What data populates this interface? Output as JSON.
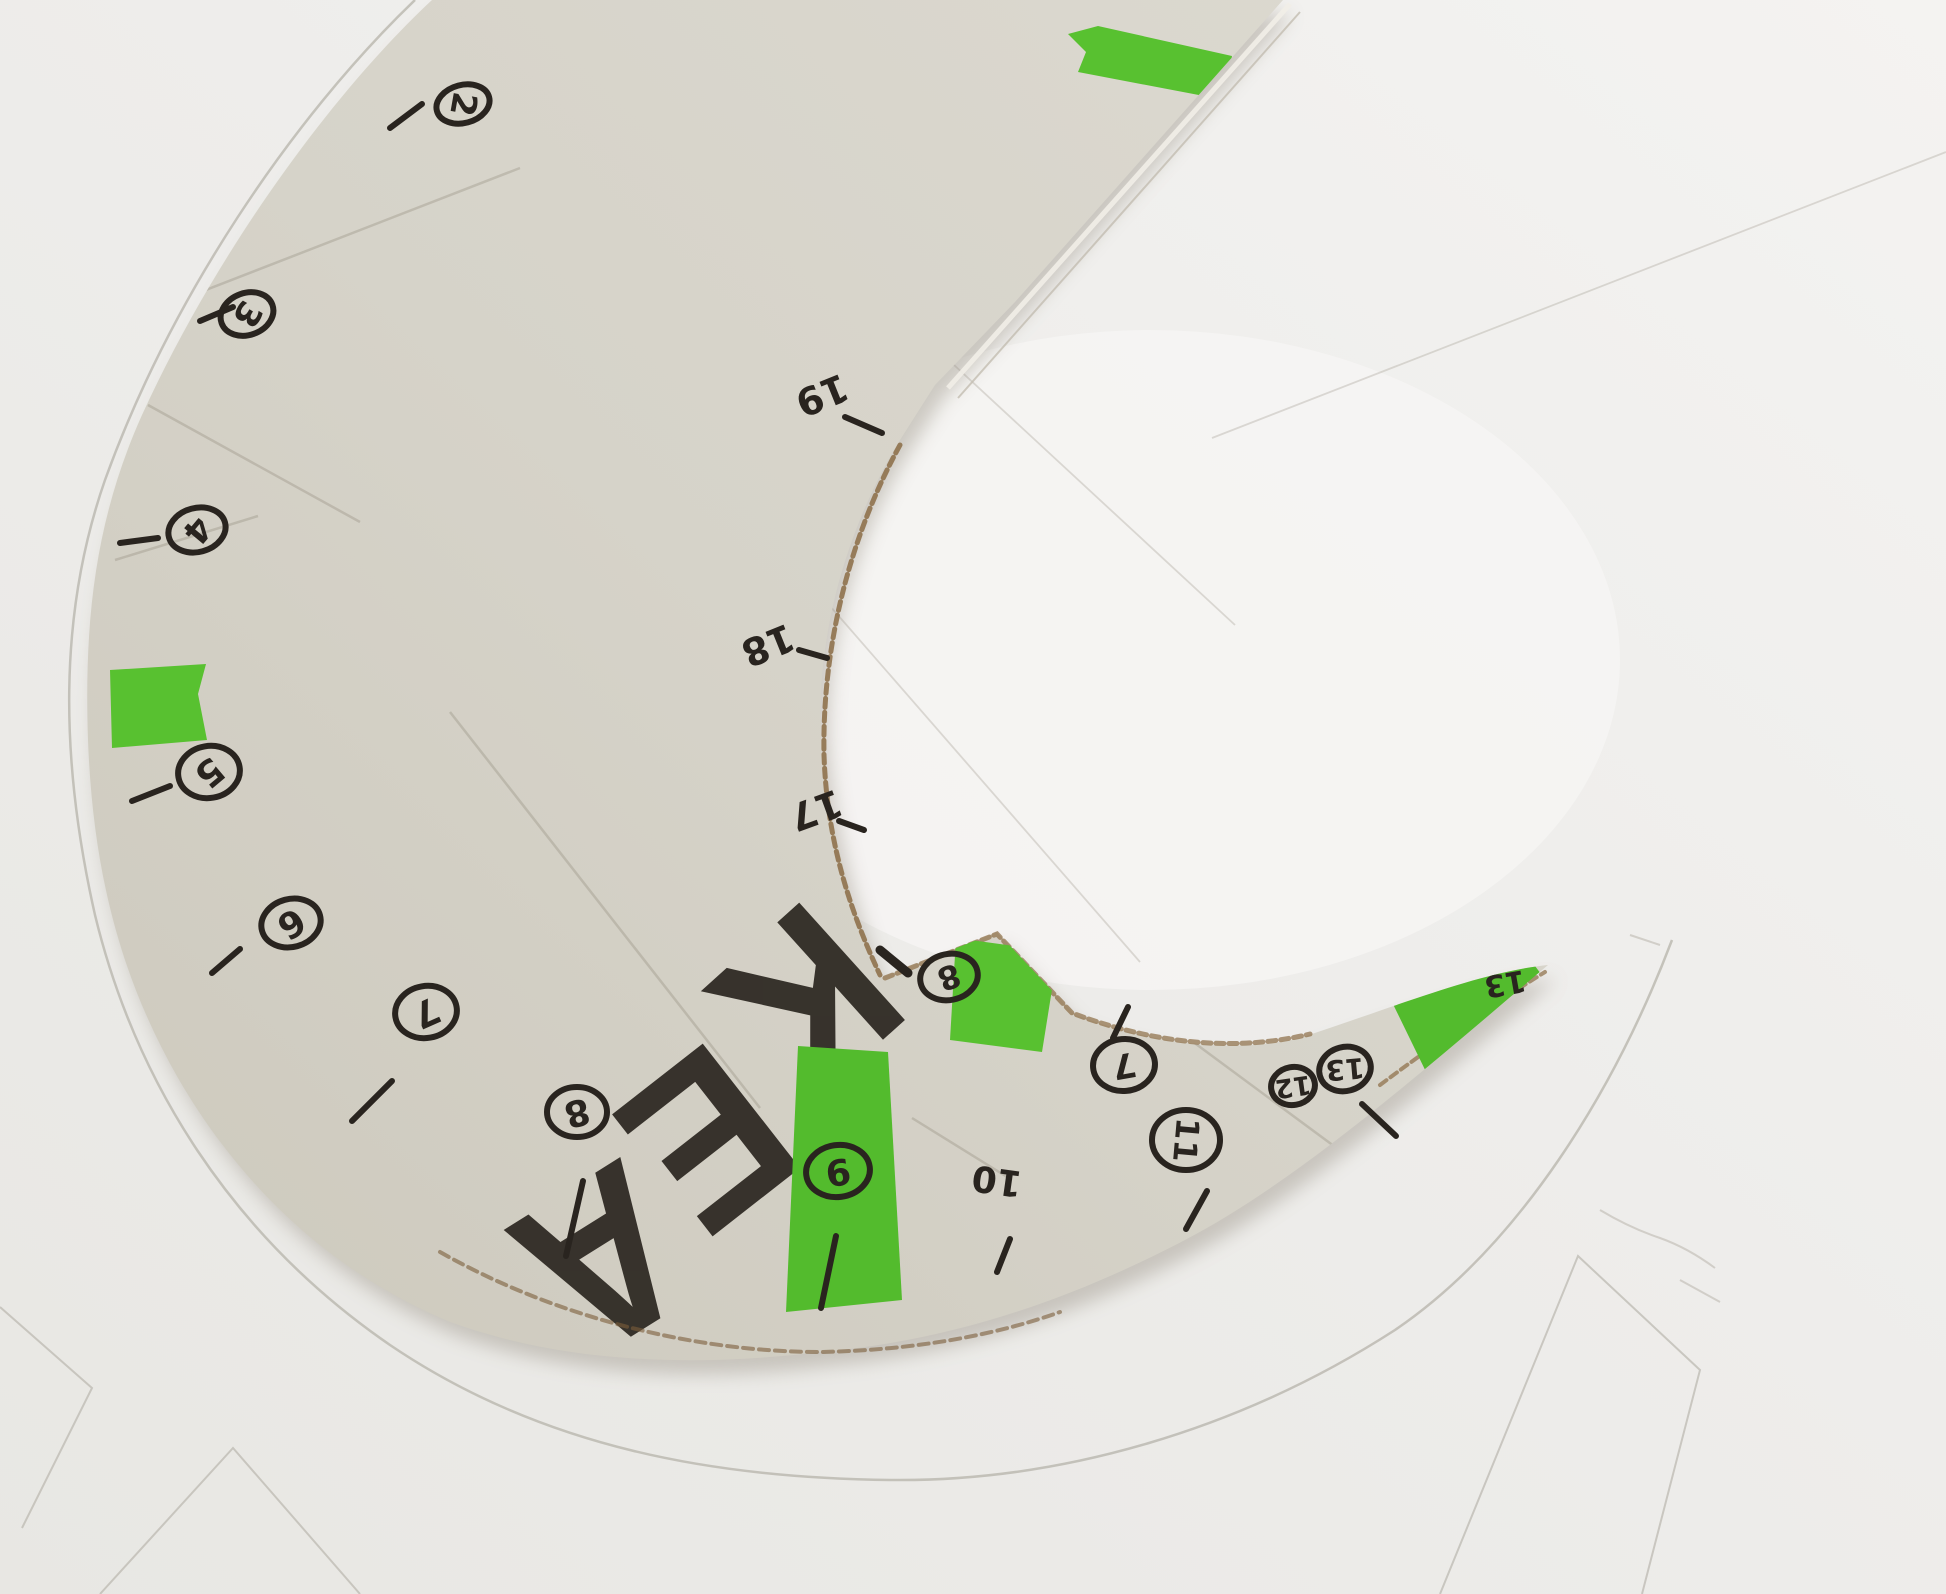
{
  "colors": {
    "paper_dark": "#e8e7e3",
    "paper_light": "#f4f3f1",
    "paper_hole_bright": "#f6f5f3",
    "cardboard_dark": "#cdc9bd",
    "cardboard_light": "#dcd9d0",
    "ink": "#29241f",
    "letter_ink": "#2c2721",
    "tape_green": "#58c130",
    "tape_green_alt": "#53bb2d",
    "torn_brown": "#8b6c45",
    "torn_brown_dark": "#7c5e3b",
    "print_line": "#b9b6ae",
    "pencil_line": "#c9c6bf",
    "shadow": "#9b9488",
    "cut_highlight": "#f2efe8",
    "cut_shadow_line": "#c4beb2",
    "crease_card": "rgba(120,110,95,0.25)",
    "crease_paper": "rgba(160,152,140,0.32)"
  },
  "cardboard": {
    "outline_path": "M 432,0 C 330,95 215,255 142,415 C 95,520 84,620 88,740 C 93,875 122,980 178,1078 C 240,1185 330,1272 450,1322 C 560,1362 690,1368 820,1352 C 960,1340 1080,1295 1185,1240 C 1300,1180 1430,1065 1548,965 C 1480,972 1400,1005 1300,1038 C 1240,1052 1165,1048 1075,1015 L 997,932 L 880,978 C 855,915 833,845 822,750 C 813,645 845,530 900,440 L 935,385 L 1015,302 L 1283,0 Z",
    "creases": [
      "M 180,300 L 520,168",
      "M 148,405 L 360,522",
      "M 115,560 L 258,516",
      "M 450,712 L 760,1108",
      "M 1058,942 L 1342,1152",
      "M 912,1118 L 1012,1180"
    ],
    "torn_edges": [
      {
        "d": "M 900,445 C 848,540 822,650 824,755 C 827,845 852,915 880,975",
        "color": "#8b6c45",
        "w": 5,
        "dash": "9 5",
        "o": 0.85
      },
      {
        "d": "M 885,978 L 997,934 L 1072,1013 C 1160,1046 1240,1051 1310,1034",
        "color": "#8b6c45",
        "w": 5,
        "dash": "8 5",
        "o": 0.7
      },
      {
        "d": "M 440,1252 C 560,1320 700,1352 820,1352 C 930,1350 1010,1330 1060,1312",
        "color": "#7c5e3b",
        "w": 4,
        "dash": "10 6",
        "o": 0.6
      },
      {
        "d": "M 1380,1085 C 1440,1040 1500,1000 1545,972",
        "color": "#8b6c45",
        "w": 4,
        "dash": "8 5",
        "o": 0.7
      }
    ],
    "cut_edge_highlight": {
      "x1": 1290,
      "y1": 4,
      "x2": 948,
      "y2": 388
    },
    "cut_edge_shadow": {
      "x1": 1300,
      "y1": 12,
      "x2": 958,
      "y2": 398
    }
  },
  "brand_text": {
    "word": "IKEA",
    "letters": [
      {
        "ch": "I",
        "x": 905,
        "y": 795,
        "rot": 142,
        "size": 205
      },
      {
        "ch": "K",
        "x": 795,
        "y": 988,
        "rot": 138,
        "size": 205
      },
      {
        "ch": "E",
        "x": 697,
        "y": 1125,
        "rot": 142,
        "size": 205
      },
      {
        "ch": "A",
        "x": 594,
        "y": 1245,
        "rot": 148,
        "size": 205
      }
    ]
  },
  "tape_pieces": [
    {
      "name": "tape-top",
      "points": "1068,34 1098,26 1232,56 1225,100 1078,72 1086,52",
      "color": "#58c130"
    },
    {
      "name": "tape-left",
      "points": "110,670 206,664 198,694 207,740 112,748",
      "color": "#58c130"
    },
    {
      "name": "tape-bottom-strip",
      "points": "798,1046 888,1052 902,1300 786,1312",
      "color": "#53bb2d"
    },
    {
      "name": "tape-inner-edge",
      "points": "956,938 1058,952 1042,1052 950,1040",
      "color": "#58c130"
    },
    {
      "name": "tape-right-tip",
      "points": "1392,1002 1520,946 1550,986 1430,1080",
      "color": "#53bb2d"
    }
  ],
  "edge_markers": [
    {
      "label": "2",
      "circled": true,
      "x": 463,
      "y": 104,
      "rx": 27,
      "ry": 19,
      "erot": -15,
      "drot": 100,
      "fs": 34,
      "tick": [
        390,
        128,
        422,
        104
      ]
    },
    {
      "label": "3",
      "circled": true,
      "x": 247,
      "y": 314,
      "rx": 27,
      "ry": 21,
      "erot": -20,
      "drot": 120,
      "fs": 34,
      "tick": [
        200,
        321,
        233,
        307
      ]
    },
    {
      "label": "4",
      "circled": true,
      "x": 197,
      "y": 530,
      "rx": 29,
      "ry": 22,
      "erot": -15,
      "drot": 130,
      "fs": 34,
      "tick": [
        120,
        543,
        158,
        538
      ]
    },
    {
      "label": "5",
      "circled": true,
      "x": 209,
      "y": 772,
      "rx": 31,
      "ry": 26,
      "erot": -10,
      "drot": 140,
      "fs": 36,
      "tick": [
        132,
        801,
        170,
        786
      ]
    },
    {
      "label": "6",
      "circled": true,
      "x": 291,
      "y": 923,
      "rx": 30,
      "ry": 24,
      "erot": -15,
      "drot": 148,
      "fs": 36,
      "tick": [
        212,
        973,
        240,
        949
      ]
    },
    {
      "label": "7",
      "circled": true,
      "x": 426,
      "y": 1012,
      "rx": 31,
      "ry": 26,
      "erot": -10,
      "drot": 156,
      "fs": 36,
      "tick": [
        352,
        1121,
        392,
        1081
      ]
    },
    {
      "label": "8",
      "circled": true,
      "x": 577,
      "y": 1112,
      "rx": 30,
      "ry": 25,
      "erot": 0,
      "drot": 165,
      "fs": 36,
      "tick": [
        583,
        1181,
        566,
        1256
      ]
    },
    {
      "label": "9",
      "circled": true,
      "x": 838,
      "y": 1171,
      "rx": 32,
      "ry": 26,
      "erot": -8,
      "drot": 172,
      "fs": 36,
      "tick": [
        836,
        1236,
        821,
        1308
      ]
    },
    {
      "label": "10",
      "circled": false,
      "x": 997,
      "y": 1180,
      "rx": 0,
      "ry": 0,
      "erot": 0,
      "drot": 188,
      "fs": 36,
      "tick": [
        1010,
        1239,
        997,
        1272
      ]
    },
    {
      "label": "11",
      "circled": true,
      "x": 1186,
      "y": 1140,
      "rx": 34,
      "ry": 30,
      "erot": 0,
      "drot": 95,
      "fs": 32,
      "tick": [
        1207,
        1191,
        1186,
        1229
      ]
    },
    {
      "label": "8",
      "circled": true,
      "x": 949,
      "y": 977,
      "rx": 29,
      "ry": 23,
      "erot": -12,
      "drot": 160,
      "fs": 32,
      "tick": null
    },
    {
      "label": "7",
      "circled": true,
      "x": 1124,
      "y": 1065,
      "rx": 31,
      "ry": 26,
      "erot": -5,
      "drot": 170,
      "fs": 34,
      "tick": [
        1113,
        1038,
        1128,
        1007
      ]
    },
    {
      "label": "12",
      "circled": true,
      "x": 1293,
      "y": 1086,
      "rx": 22,
      "ry": 19,
      "erot": -10,
      "drot": 172,
      "fs": 26,
      "tick": null
    },
    {
      "label": "13",
      "circled": true,
      "x": 1345,
      "y": 1069,
      "rx": 26,
      "ry": 22,
      "erot": -15,
      "drot": 175,
      "fs": 28,
      "tick": null
    },
    {
      "label": "13",
      "circled": false,
      "x": 1505,
      "y": 983,
      "rx": 0,
      "ry": 0,
      "erot": 0,
      "drot": 170,
      "fs": 30,
      "tick": null
    },
    {
      "label": "19",
      "circled": false,
      "x": 822,
      "y": 395,
      "rx": 0,
      "ry": 0,
      "erot": 0,
      "drot": 158,
      "fs": 38,
      "tick": [
        845,
        417,
        882,
        433
      ]
    },
    {
      "label": "18",
      "circled": false,
      "x": 768,
      "y": 645,
      "rx": 0,
      "ry": 0,
      "erot": 0,
      "drot": 158,
      "fs": 38,
      "tick": [
        799,
        650,
        827,
        658
      ]
    },
    {
      "label": "17",
      "circled": false,
      "x": 816,
      "y": 810,
      "rx": 0,
      "ry": 0,
      "erot": 0,
      "drot": 160,
      "fs": 38,
      "tick": [
        839,
        821,
        864,
        830
      ]
    }
  ],
  "extra_ticks": [
    {
      "x1": 880,
      "y1": 950,
      "x2": 908,
      "y2": 973,
      "w": 9
    },
    {
      "x1": 1362,
      "y1": 1104,
      "x2": 1396,
      "y2": 1136,
      "w": 6
    }
  ],
  "paper_pattern": {
    "big_arc": "M 415,0 C 290,120 170,300 105,480 C 58,615 60,760 95,915 C 135,1080 230,1235 390,1345 C 545,1450 720,1478 890,1480 C 1060,1482 1240,1430 1395,1330 C 1520,1245 1615,1090 1672,940",
    "shapes": [
      "M 0,1307 L 92,1388 L 22,1528",
      "M 100,1594 L 233,1448 L 360,1594",
      "M 1440,1594 L 1578,1256 L 1700,1370 L 1642,1594"
    ],
    "pencil_marks": [
      "M 1600,1210 q 30,18 60,28 q 28,10 55,30",
      "M 1680,1280 l 40,22",
      "M 1630,935 l 30,10"
    ],
    "paper_creases": [
      "M 1212,438 L 1946,152",
      "M 940,352 L 1235,625",
      "M 823,598 L 1140,962"
    ]
  }
}
